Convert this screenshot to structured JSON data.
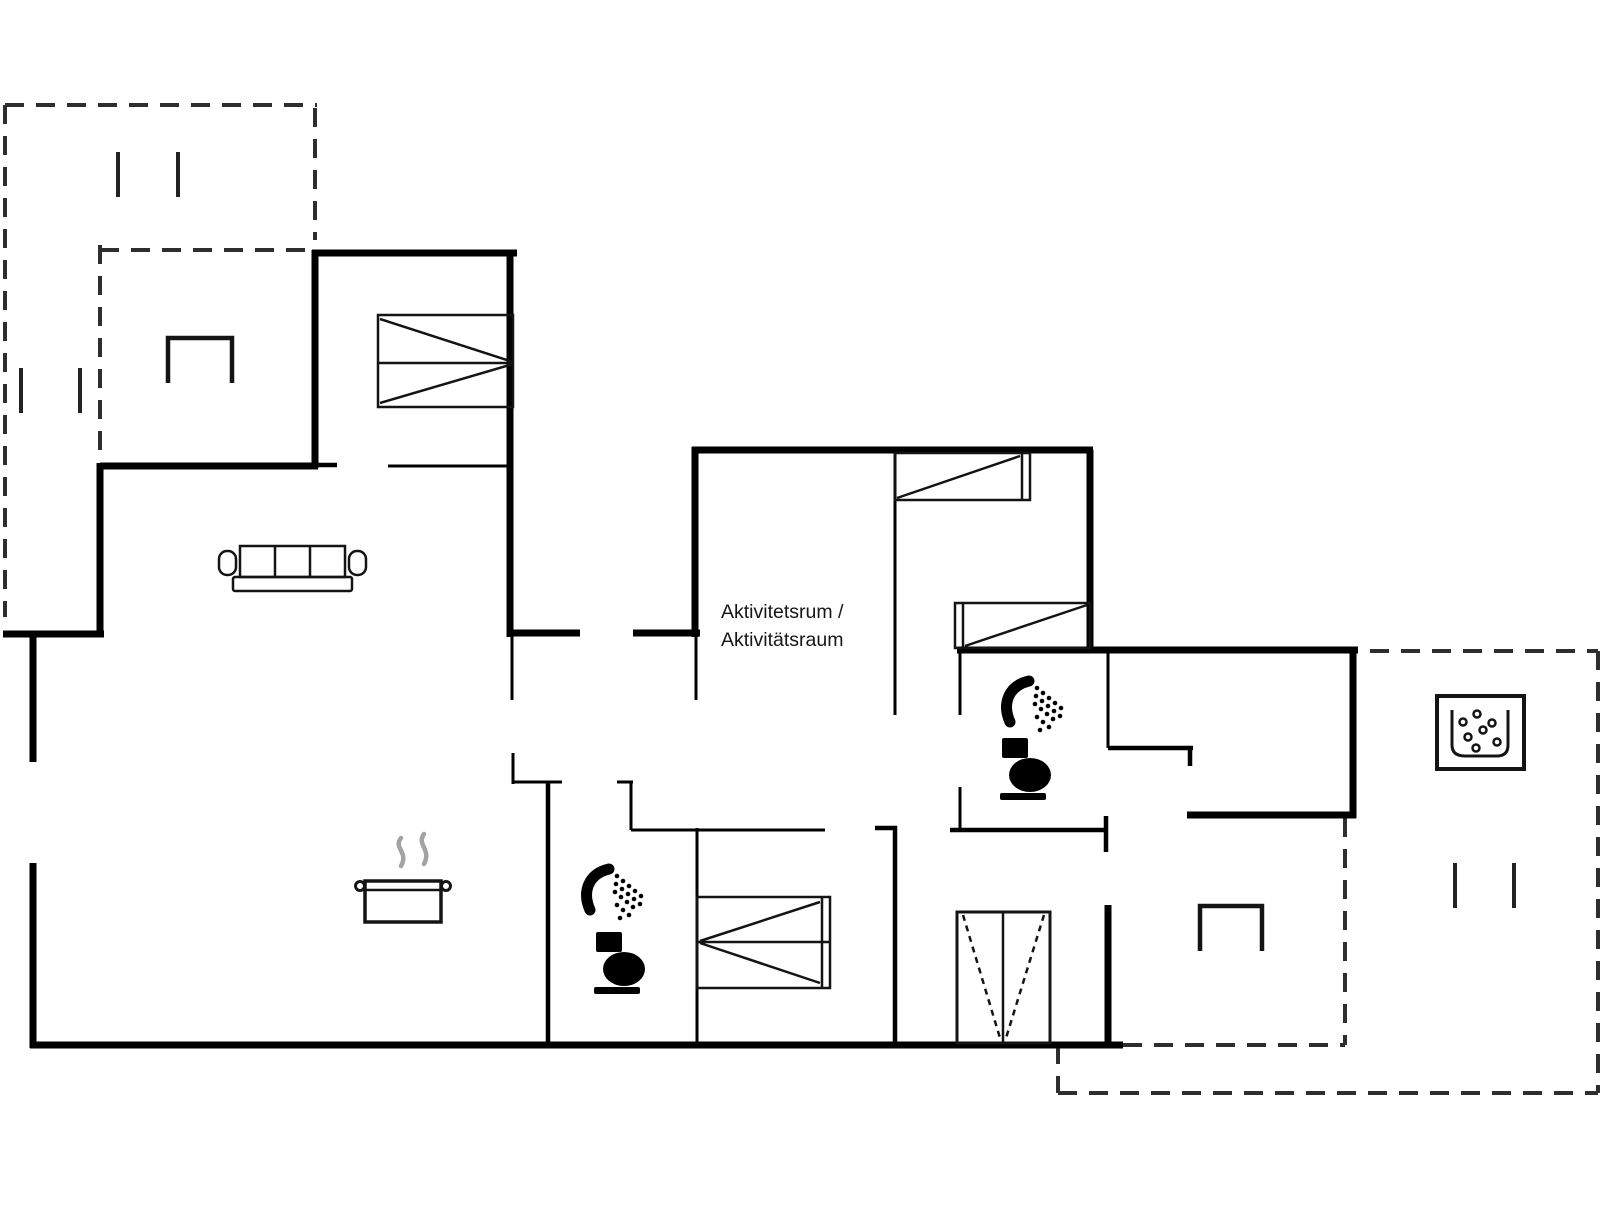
{
  "canvas": {
    "width": 1606,
    "height": 1205,
    "background": "#ffffff"
  },
  "colors": {
    "wall": "#000000",
    "terrace_dash": "#2e2e2e",
    "furniture_line": "#141414",
    "icon_fill": "#000000",
    "steam": "#a3a3a3",
    "label_text": "#161616"
  },
  "room_label": {
    "line1": "Aktivitetsrum /",
    "line2": "Aktivitätsraum"
  },
  "icons": [
    "double-bed-icon",
    "single-bed-icon",
    "single-bed-icon",
    "double-bed-icon",
    "wardrobe-icon",
    "sofa-icon",
    "cooking-pot-icon",
    "steam-icon",
    "shower-icon",
    "toilet-icon",
    "shower-icon",
    "toilet-icon",
    "hot-tub-icon",
    "armchair-icon",
    "armchair-icon",
    "post-mark-icon"
  ]
}
